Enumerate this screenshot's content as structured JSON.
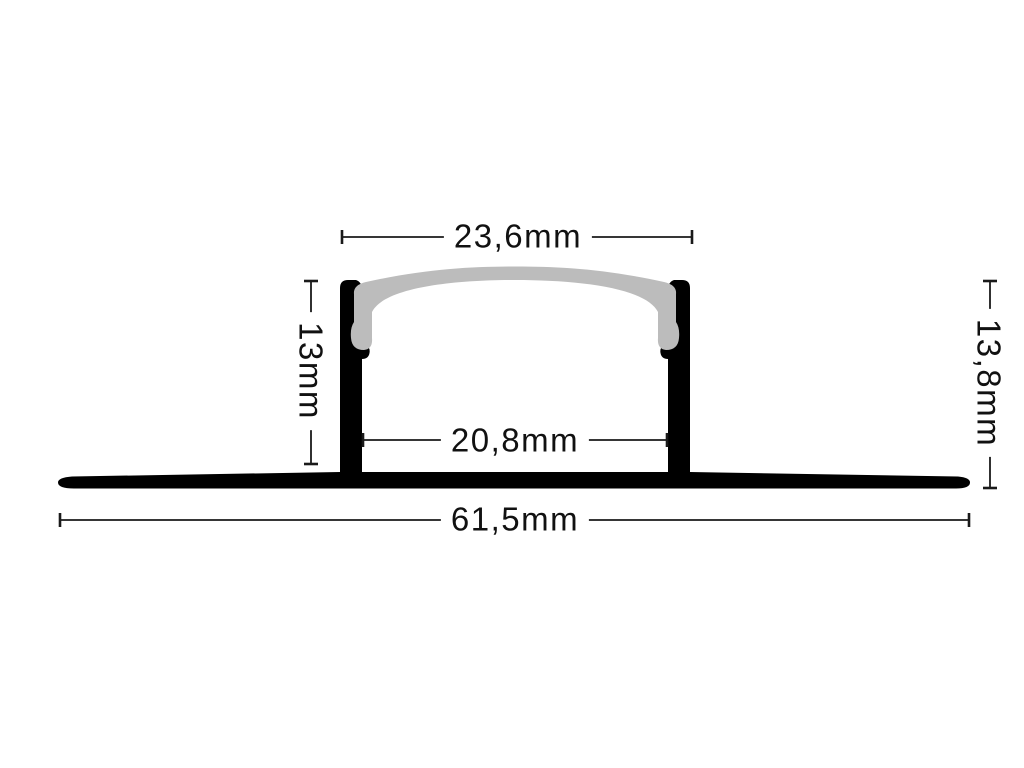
{
  "diagram": {
    "type": "profile-cross-section",
    "unit": "mm",
    "dimensions": {
      "top_width": {
        "label": "23,6mm"
      },
      "inner_width": {
        "label": "20,8mm"
      },
      "total_width": {
        "label": "61,5mm"
      },
      "left_height": {
        "label": "13mm"
      },
      "right_height": {
        "label": "13,8mm"
      }
    }
  },
  "colors": {
    "background": "#ffffff",
    "profile": "#000000",
    "diffuser": "#bcbcbc",
    "dimension_lines": "#1a1a1a"
  }
}
